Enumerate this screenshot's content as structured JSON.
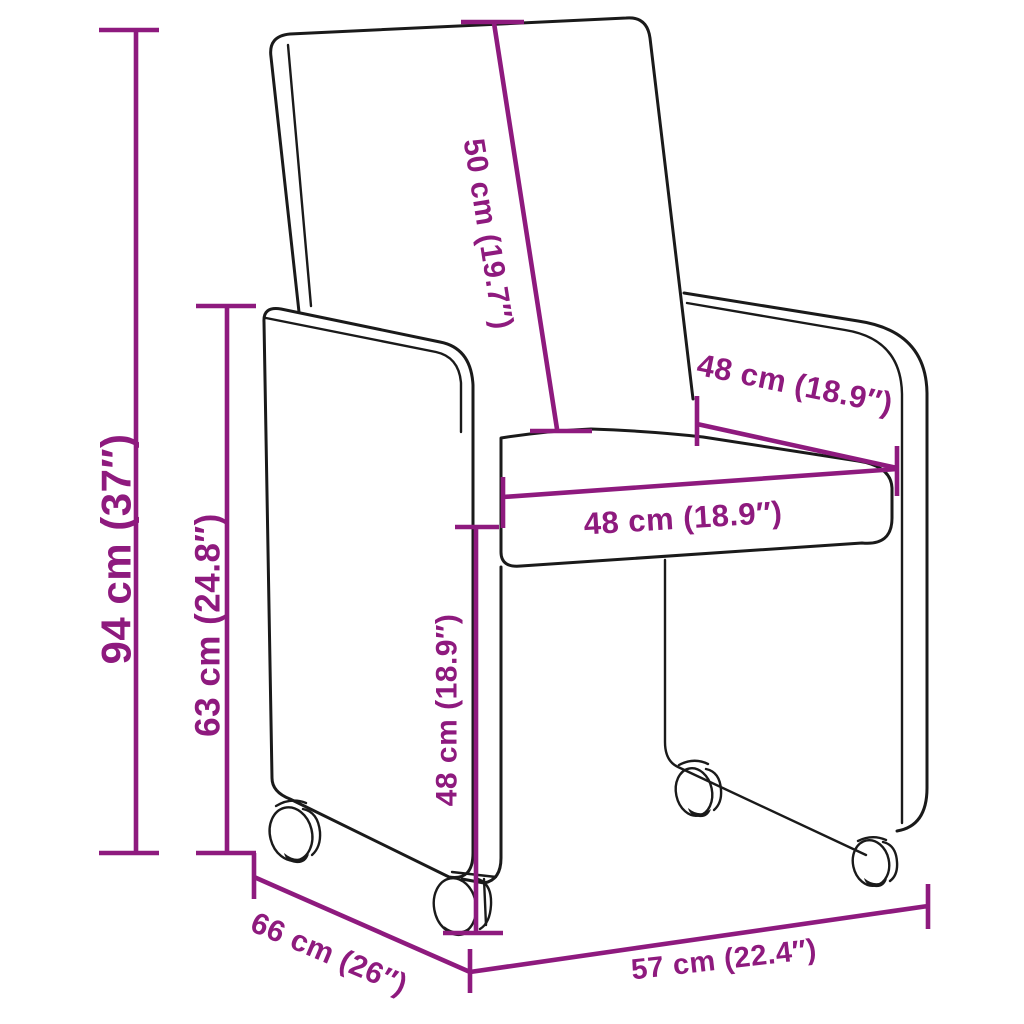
{
  "colors": {
    "accent": "#8e1a7e",
    "outline": "#1a1a1a",
    "bg": "#ffffff"
  },
  "diagram": {
    "description": "Dimension diagram of an upholstered armchair on caster wheels",
    "unit_style": "centimeters with inches in parentheses",
    "labels": {
      "total_height": "94 cm (37″)",
      "arm_height": "63 cm (24.8″)",
      "backrest_length": "50 cm (19.7″)",
      "seat_width": "48 cm (18.9″)",
      "seat_depth": "48 cm (18.9″)",
      "seat_height": "48 cm (18.9″)",
      "total_depth": "66 cm (26″)",
      "total_width": "57 cm (22.4″)"
    }
  }
}
